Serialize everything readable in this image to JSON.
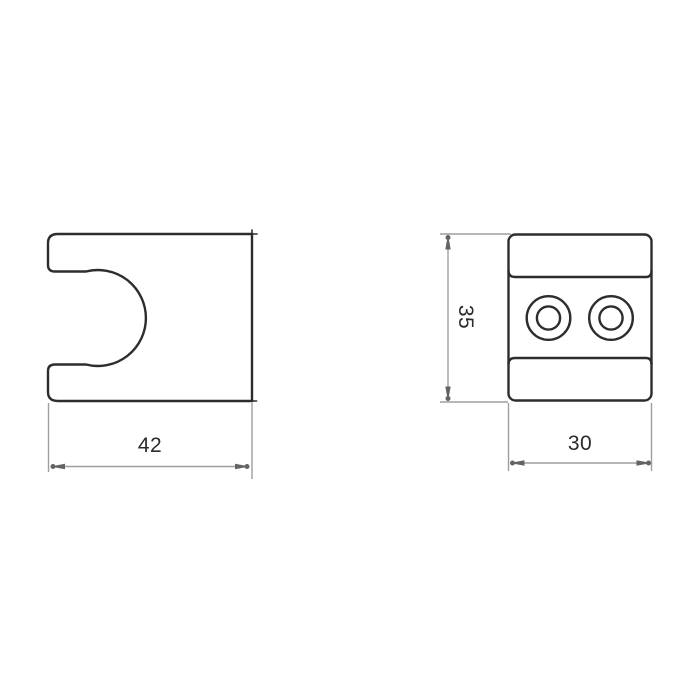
{
  "drawing": {
    "type": "technical-dimension-drawing",
    "colors": {
      "background": "#ffffff",
      "outline": "#2d2d2d",
      "dimension_line": "#9e9e9e",
      "arrowhead": "#646464",
      "label_text": "#2b2b2b"
    },
    "side_view": {
      "width_label": "42"
    },
    "front_view": {
      "height_label": "35",
      "width_label": "30",
      "screw_hole_count": 2
    }
  }
}
